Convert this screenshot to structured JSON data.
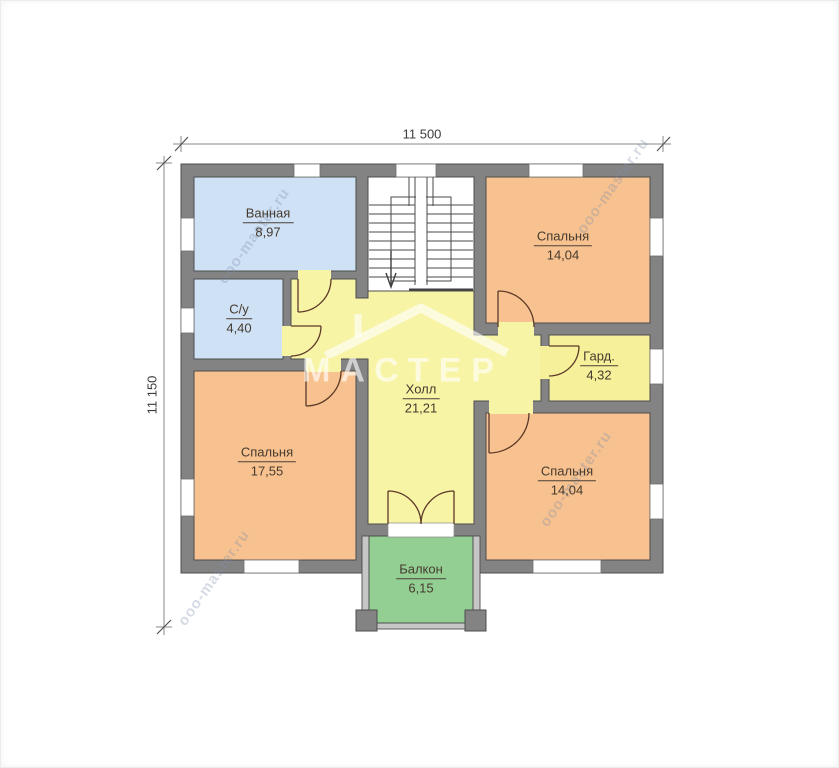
{
  "plan": {
    "title_hint": "floor-plan",
    "dimensions": {
      "top": "11 500",
      "left": "11 150"
    },
    "rooms": [
      {
        "key": "bathroom",
        "name": "Ванная",
        "area": "8,97"
      },
      {
        "key": "wc",
        "name": "С/у",
        "area": "4,40"
      },
      {
        "key": "bedroom-top-right",
        "name": "Спальня",
        "area": "14,04"
      },
      {
        "key": "wardrobe",
        "name": "Гард.",
        "area": "4,32"
      },
      {
        "key": "hall",
        "name": "Холл",
        "area": "21,21"
      },
      {
        "key": "bedroom-left",
        "name": "Спальня",
        "area": "17,55"
      },
      {
        "key": "bedroom-bottom-right",
        "name": "Спальня",
        "area": "14,04"
      },
      {
        "key": "balcony",
        "name": "Балкон",
        "area": "6,15"
      }
    ],
    "watermark": {
      "brand": "МАСТЕР",
      "url": "ooo-master.ru"
    },
    "colors": {
      "wall": "#838383",
      "wet_rooms": "#cfe1f5",
      "bedrooms": "#f7c28f",
      "hall": "#f8f4a6",
      "balcony": "#93cf93",
      "stairwell": "#ffffff",
      "door_arc": "#5d3a28",
      "dimension_line": "#8a8a8a",
      "label_text": "#453a2e"
    }
  }
}
